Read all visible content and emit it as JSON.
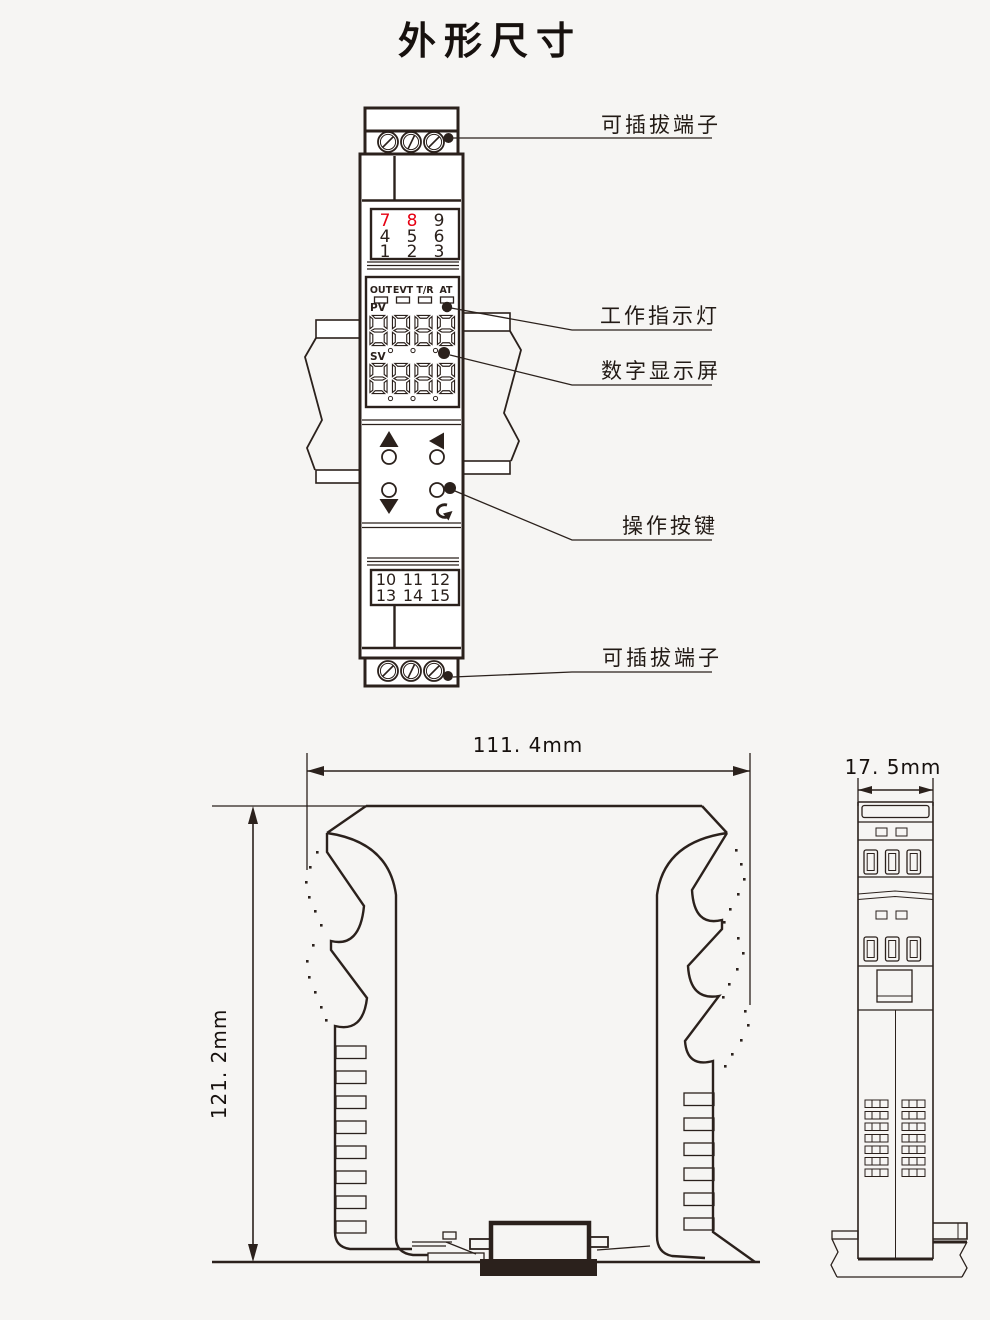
{
  "title": "外形尺寸",
  "colors": {
    "line": "#2b211c",
    "accent_red": "#e60012",
    "background": "#f6f5f3"
  },
  "front_view": {
    "callouts": {
      "terminal_top": "可插拔端子",
      "indicator": "工作指示灯",
      "display": "数字显示屏",
      "buttons": "操作按键",
      "terminal_bottom": "可插拔端子"
    },
    "upper_terminal_numbers": {
      "row1": [
        "7",
        "8",
        "9"
      ],
      "row2": [
        "4",
        "5",
        "6"
      ],
      "row3": [
        "1",
        "2",
        "3"
      ]
    },
    "lower_terminal_numbers": {
      "row1": [
        "10",
        "11",
        "12"
      ],
      "row2": [
        "13",
        "14",
        "15"
      ]
    },
    "led_labels": [
      "OUT",
      "EVT",
      "T/R",
      "AT"
    ],
    "pv_label": "PV",
    "sv_label": "SV"
  },
  "side_view": {
    "width_dim": "111. 4mm",
    "height_dim": "121. 2mm"
  },
  "end_view": {
    "depth_dim": "17. 5mm"
  }
}
